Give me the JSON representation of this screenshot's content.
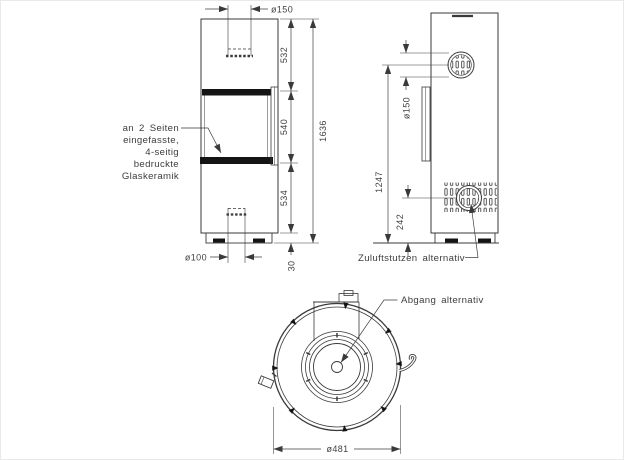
{
  "drawing": {
    "glass_note": {
      "lines": [
        "an 2 Seiten",
        "eingefasste,",
        "4-seitig",
        "bedruckte",
        "Glaskeramik"
      ]
    },
    "front_view": {
      "dim_flue_diameter": "ø150",
      "dim_height_top": "532",
      "dim_height_window": "540",
      "dim_height_bottom": "534",
      "dim_base_height": "30",
      "dim_total_height": "1636",
      "dim_air_inlet_diameter": "ø100"
    },
    "side_view": {
      "dim_flue_diameter": "ø150",
      "dim_flue_center_height": "1247",
      "dim_inlet_center_height": "242",
      "label_air_inlet": "Zuluftstutzen alternativ"
    },
    "top_view": {
      "label_outlet": "Abgang alternativ",
      "dim_outer_diameter": "ø481"
    },
    "colors": {
      "line": "#3a3a3a",
      "text": "#424242",
      "dark_fill": "#141414",
      "background": "#ffffff"
    }
  }
}
